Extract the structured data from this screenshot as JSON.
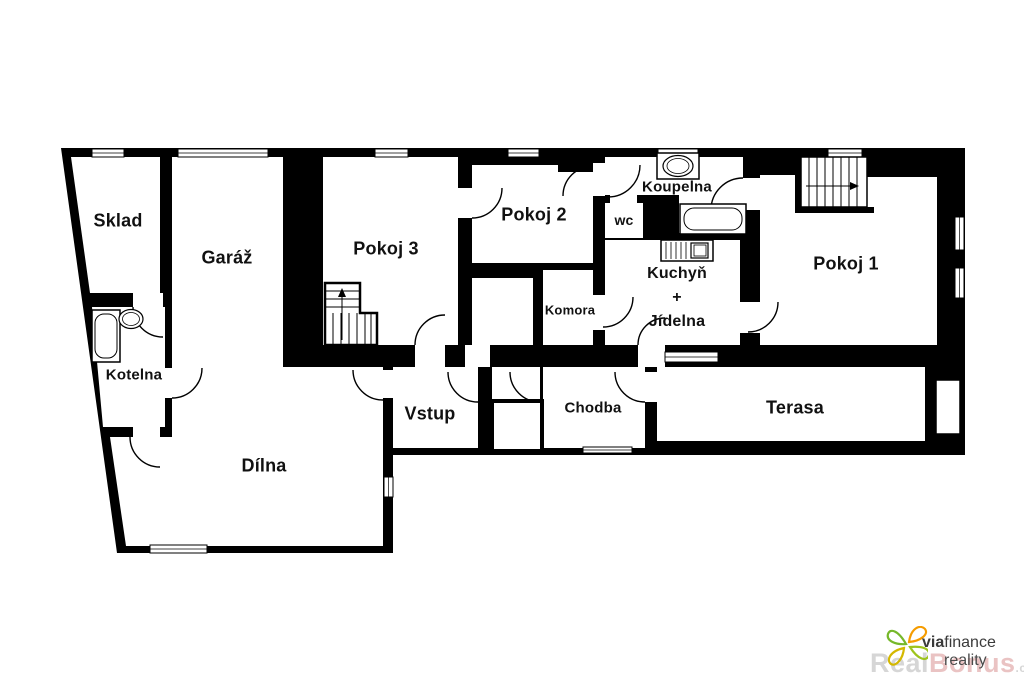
{
  "floorplan": {
    "wall_color": "#000000",
    "rooms": {
      "sklad": {
        "label": "Sklad"
      },
      "garaz": {
        "label": "Garáž"
      },
      "pokoj3": {
        "label": "Pokoj 3"
      },
      "pokoj2": {
        "label": "Pokoj 2"
      },
      "koupelna": {
        "label": "Koupelna"
      },
      "wc": {
        "label": "wc"
      },
      "kuchyn_jidelna": {
        "line1": "Kuchyň",
        "line2": "+",
        "line3": "Jídelna"
      },
      "pokoj1": {
        "label": "Pokoj 1"
      },
      "kotelna": {
        "label": "Kotelna"
      },
      "komora": {
        "label": "Komora"
      },
      "vstup": {
        "label": "Vstup"
      },
      "chodba": {
        "label": "Chodba"
      },
      "dilna": {
        "label": "Dílna"
      },
      "terasa": {
        "label": "Terasa"
      }
    },
    "logo": {
      "brand_bold": "via",
      "brand_rest": "finance",
      "line2": "reality",
      "watermark_part1": "Real",
      "watermark_part2": "Bonus",
      "watermark_suffix": ".cz",
      "colors": {
        "petal_green": "#76b82a",
        "petal_orange": "#f59c00",
        "petal_yellow": "#d4b800",
        "petal_lime": "#9ec41c",
        "brand_text": "#3b3b3b",
        "reality_text": "#4a4a4a"
      }
    }
  }
}
